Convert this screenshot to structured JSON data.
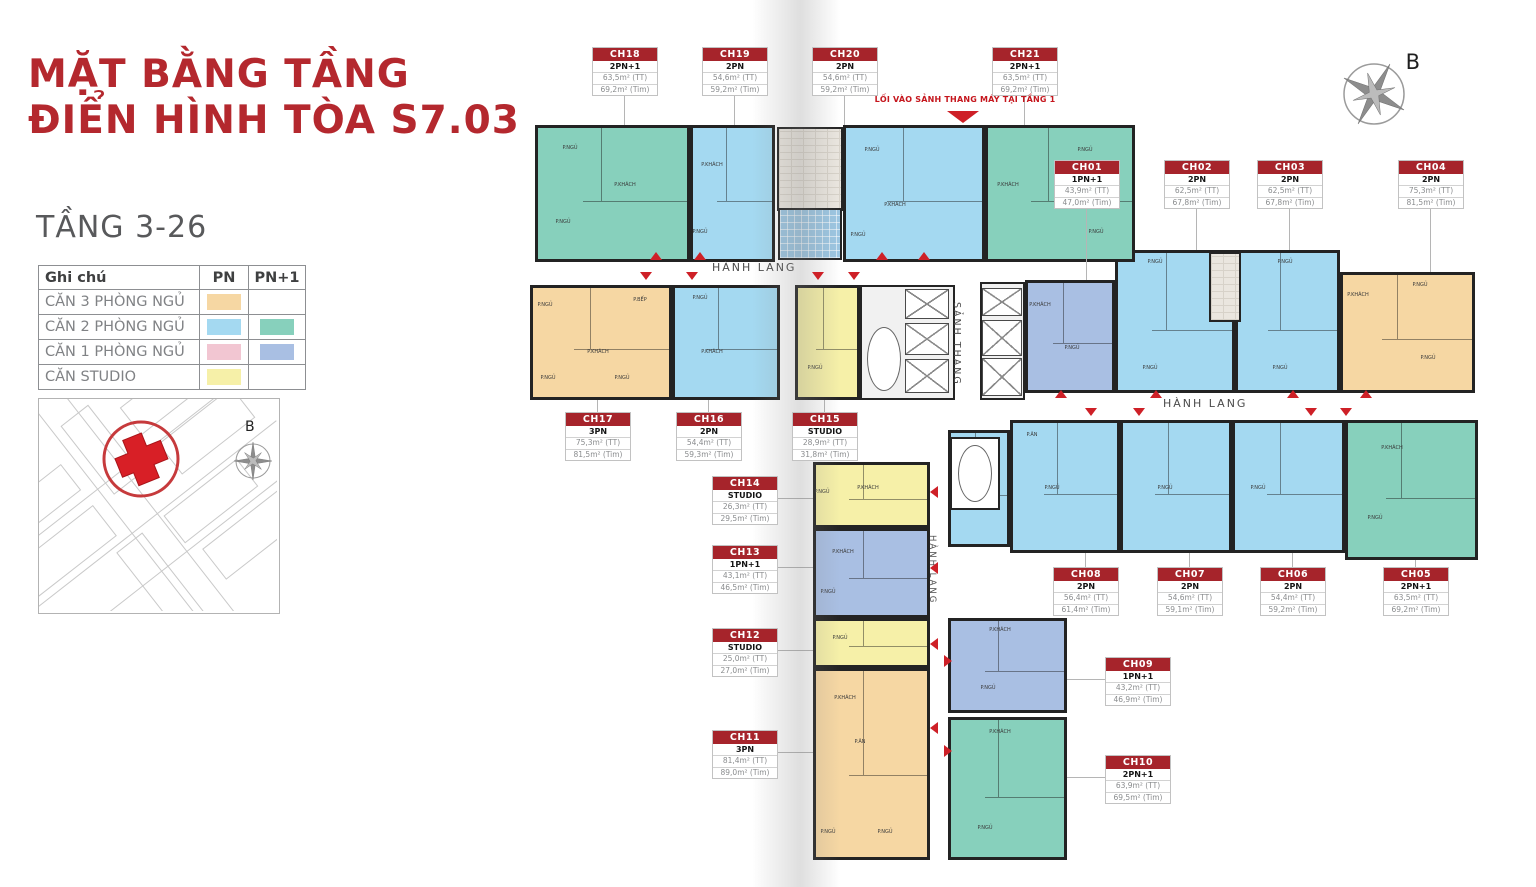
{
  "title": {
    "line1": "MẶT BẰNG TẦNG",
    "line2": "ĐIỂN HÌNH TÒA S7.03"
  },
  "floor_range": "TẦNG 3-26",
  "legend": {
    "header": {
      "name": "Ghi chú",
      "pn": "PN",
      "pn1": "PN+1"
    },
    "rows": [
      {
        "label": "CĂN 3 PHÒNG NGỦ",
        "pn_color": "#F6D7A3",
        "pn1_color": null
      },
      {
        "label": "CĂN 2 PHÒNG NGỦ",
        "pn_color": "#A4D9F1",
        "pn1_color": "#87D0BC"
      },
      {
        "label": "CĂN 1 PHÒNG NGỦ",
        "pn_color": "#F2C6D2",
        "pn1_color": "#A9BFE3"
      },
      {
        "label": "CĂN STUDIO",
        "pn_color": "#F6F0A8",
        "pn1_color": null
      }
    ]
  },
  "compass_label": "B",
  "site_map": {
    "compass_label": "B"
  },
  "entrance_note": "LỐI VÀO SẢNH THANG MÁY TẠI TẦNG 1",
  "plan": {
    "corridors": [
      "HÀNH LANG",
      "SẢNH THANG",
      "HÀNH LANG",
      "HÀNH LANG"
    ],
    "room_labels": [
      "P.NGỦ",
      "P.KHÁCH",
      "P.BẾP",
      "P.ĂN",
      "WC",
      "LÔ GIA"
    ]
  },
  "units": [
    {
      "id": "CH01",
      "type": "1PN+1",
      "area_tt": "43,9m² (TT)",
      "area_tim": "47,0m² (Tim)"
    },
    {
      "id": "CH02",
      "type": "2PN",
      "area_tt": "62,5m² (TT)",
      "area_tim": "67,8m² (Tim)"
    },
    {
      "id": "CH03",
      "type": "2PN",
      "area_tt": "62,5m² (TT)",
      "area_tim": "67,8m² (Tim)"
    },
    {
      "id": "CH04",
      "type": "2PN",
      "area_tt": "75,3m² (TT)",
      "area_tim": "81,5m² (Tim)"
    },
    {
      "id": "CH05",
      "type": "2PN+1",
      "area_tt": "63,5m² (TT)",
      "area_tim": "69,2m² (Tim)"
    },
    {
      "id": "CH06",
      "type": "2PN",
      "area_tt": "54,4m² (TT)",
      "area_tim": "59,2m² (Tim)"
    },
    {
      "id": "CH07",
      "type": "2PN",
      "area_tt": "54,6m² (TT)",
      "area_tim": "59,1m² (Tim)"
    },
    {
      "id": "CH08",
      "type": "2PN",
      "area_tt": "56,4m² (TT)",
      "area_tim": "61,4m² (Tim)"
    },
    {
      "id": "CH09",
      "type": "1PN+1",
      "area_tt": "43,2m² (TT)",
      "area_tim": "46,9m² (Tim)"
    },
    {
      "id": "CH10",
      "type": "2PN+1",
      "area_tt": "63,9m² (TT)",
      "area_tim": "69,5m² (Tim)"
    },
    {
      "id": "CH11",
      "type": "3PN",
      "area_tt": "81,4m² (TT)",
      "area_tim": "89,0m² (Tim)"
    },
    {
      "id": "CH12",
      "type": "STUDIO",
      "area_tt": "25,0m² (TT)",
      "area_tim": "27,0m² (Tim)"
    },
    {
      "id": "CH13",
      "type": "1PN+1",
      "area_tt": "43,1m² (TT)",
      "area_tim": "46,5m² (Tim)"
    },
    {
      "id": "CH14",
      "type": "STUDIO",
      "area_tt": "26,3m² (TT)",
      "area_tim": "29,5m² (Tim)"
    },
    {
      "id": "CH15",
      "type": "STUDIO",
      "area_tt": "28,9m² (TT)",
      "area_tim": "31,8m² (Tim)"
    },
    {
      "id": "CH16",
      "type": "2PN",
      "area_tt": "54,4m² (TT)",
      "area_tim": "59,3m² (Tim)"
    },
    {
      "id": "CH17",
      "type": "3PN",
      "area_tt": "75,3m² (TT)",
      "area_tim": "81,5m² (Tim)"
    },
    {
      "id": "CH18",
      "type": "2PN+1",
      "area_tt": "63,5m² (TT)",
      "area_tim": "69,2m² (Tim)"
    },
    {
      "id": "CH19",
      "type": "2PN",
      "area_tt": "54,6m² (TT)",
      "area_tim": "59,2m² (Tim)"
    },
    {
      "id": "CH20",
      "type": "2PN",
      "area_tt": "54,6m² (TT)",
      "area_tim": "59,2m² (Tim)"
    },
    {
      "id": "CH21",
      "type": "2PN+1",
      "area_tt": "63,5m² (TT)",
      "area_tim": "69,2m² (Tim)"
    }
  ]
}
